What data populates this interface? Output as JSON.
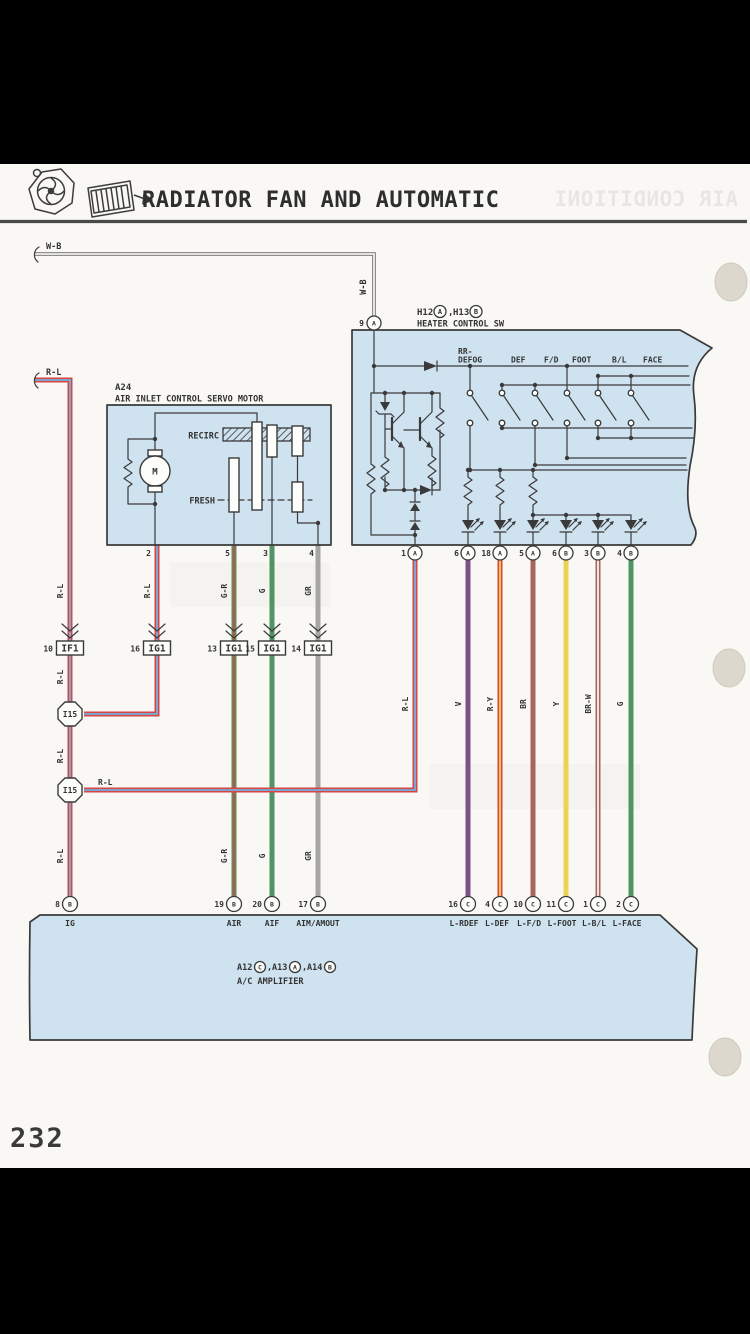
{
  "page": {
    "number": "232",
    "title": "RADIATOR FAN AND AUTOMATIC",
    "ghost_title": "AIR CONDITIONI"
  },
  "colors": {
    "line": "#3a3a3a",
    "box_fill": "#cfe2ef",
    "wire_red": "#d94545",
    "wire_blue": "#6fb3e0",
    "wire_green": "#4f9463",
    "wire_gray": "#a6a6a3",
    "wire_violet": "#7a5283",
    "wire_brown": "#a8655f",
    "wire_yellow": "#eed352",
    "wire_white": "#f4f2ec"
  },
  "top_wires": {
    "wb": "W-B",
    "rl": "R-L"
  },
  "heater": {
    "id_line": {
      "c1": "H12",
      "t1": "A",
      "s1": ",",
      "c2": "H13",
      "t2": "B"
    },
    "name": "HEATER CONTROL SW",
    "pin9": {
      "num": "9",
      "t": "A"
    },
    "modes": [
      "RR-",
      "DEFOG",
      "DEF",
      "F/D",
      "FOOT",
      "B/L",
      "FACE"
    ],
    "pins": [
      {
        "num": "1",
        "t": "A"
      },
      {
        "num": "6",
        "t": "A"
      },
      {
        "num": "18",
        "t": "A"
      },
      {
        "num": "5",
        "t": "A"
      },
      {
        "num": "6",
        "t": "B"
      },
      {
        "num": "3",
        "t": "B"
      },
      {
        "num": "4",
        "t": "B"
      }
    ]
  },
  "servo": {
    "id": "A24",
    "name": "AIR INLET CONTROL SERVO MOTOR",
    "recirc": "RECIRC",
    "fresh": "FRESH",
    "motor": "M",
    "pins": [
      "2",
      "5",
      "3",
      "4"
    ]
  },
  "connectors": [
    {
      "num": "10",
      "label": "IF1"
    },
    {
      "num": "16",
      "label": "IG1"
    },
    {
      "num": "13",
      "label": "IG1"
    },
    {
      "num": "15",
      "label": "IG1"
    },
    {
      "num": "14",
      "label": "IG1"
    }
  ],
  "junctions": [
    "I15",
    "I15"
  ],
  "wire_labels": {
    "cols_upper": [
      "R-L",
      "R-L",
      "G-R",
      "G",
      "GR"
    ],
    "col1_extra": [
      "R-L",
      "R-L",
      "R-L"
    ],
    "cols_lower": [
      "G-R",
      "G",
      "GR"
    ],
    "right": [
      "R-L",
      "V",
      "R-Y",
      "BR",
      "Y",
      "BR-W",
      "G"
    ],
    "join": "R-L"
  },
  "amplifier": {
    "id_line": {
      "c1": "A12",
      "t1": "C",
      "s1": ",",
      "c2": "A13",
      "t2": "A",
      "s2": ",",
      "c3": "A14",
      "t3": "B"
    },
    "name": "A/C AMPLIFIER",
    "left_terminals": [
      {
        "num": "8",
        "t": "B",
        "label": "IG"
      },
      {
        "num": "19",
        "t": "B",
        "label": "AIR"
      },
      {
        "num": "20",
        "t": "B",
        "label": "AIF"
      },
      {
        "num": "17",
        "t": "B",
        "label": "AIM/AMOUT"
      }
    ],
    "right_terminals": [
      {
        "num": "16",
        "t": "C",
        "label": "L-RDEF"
      },
      {
        "num": "4",
        "t": "C",
        "label": "L-DEF"
      },
      {
        "num": "10",
        "t": "C",
        "label": "L-F/D"
      },
      {
        "num": "11",
        "t": "C",
        "label": "L-FOOT"
      },
      {
        "num": "1",
        "t": "C",
        "label": "L-B/L"
      },
      {
        "num": "2",
        "t": "C",
        "label": "L-FACE"
      }
    ]
  }
}
